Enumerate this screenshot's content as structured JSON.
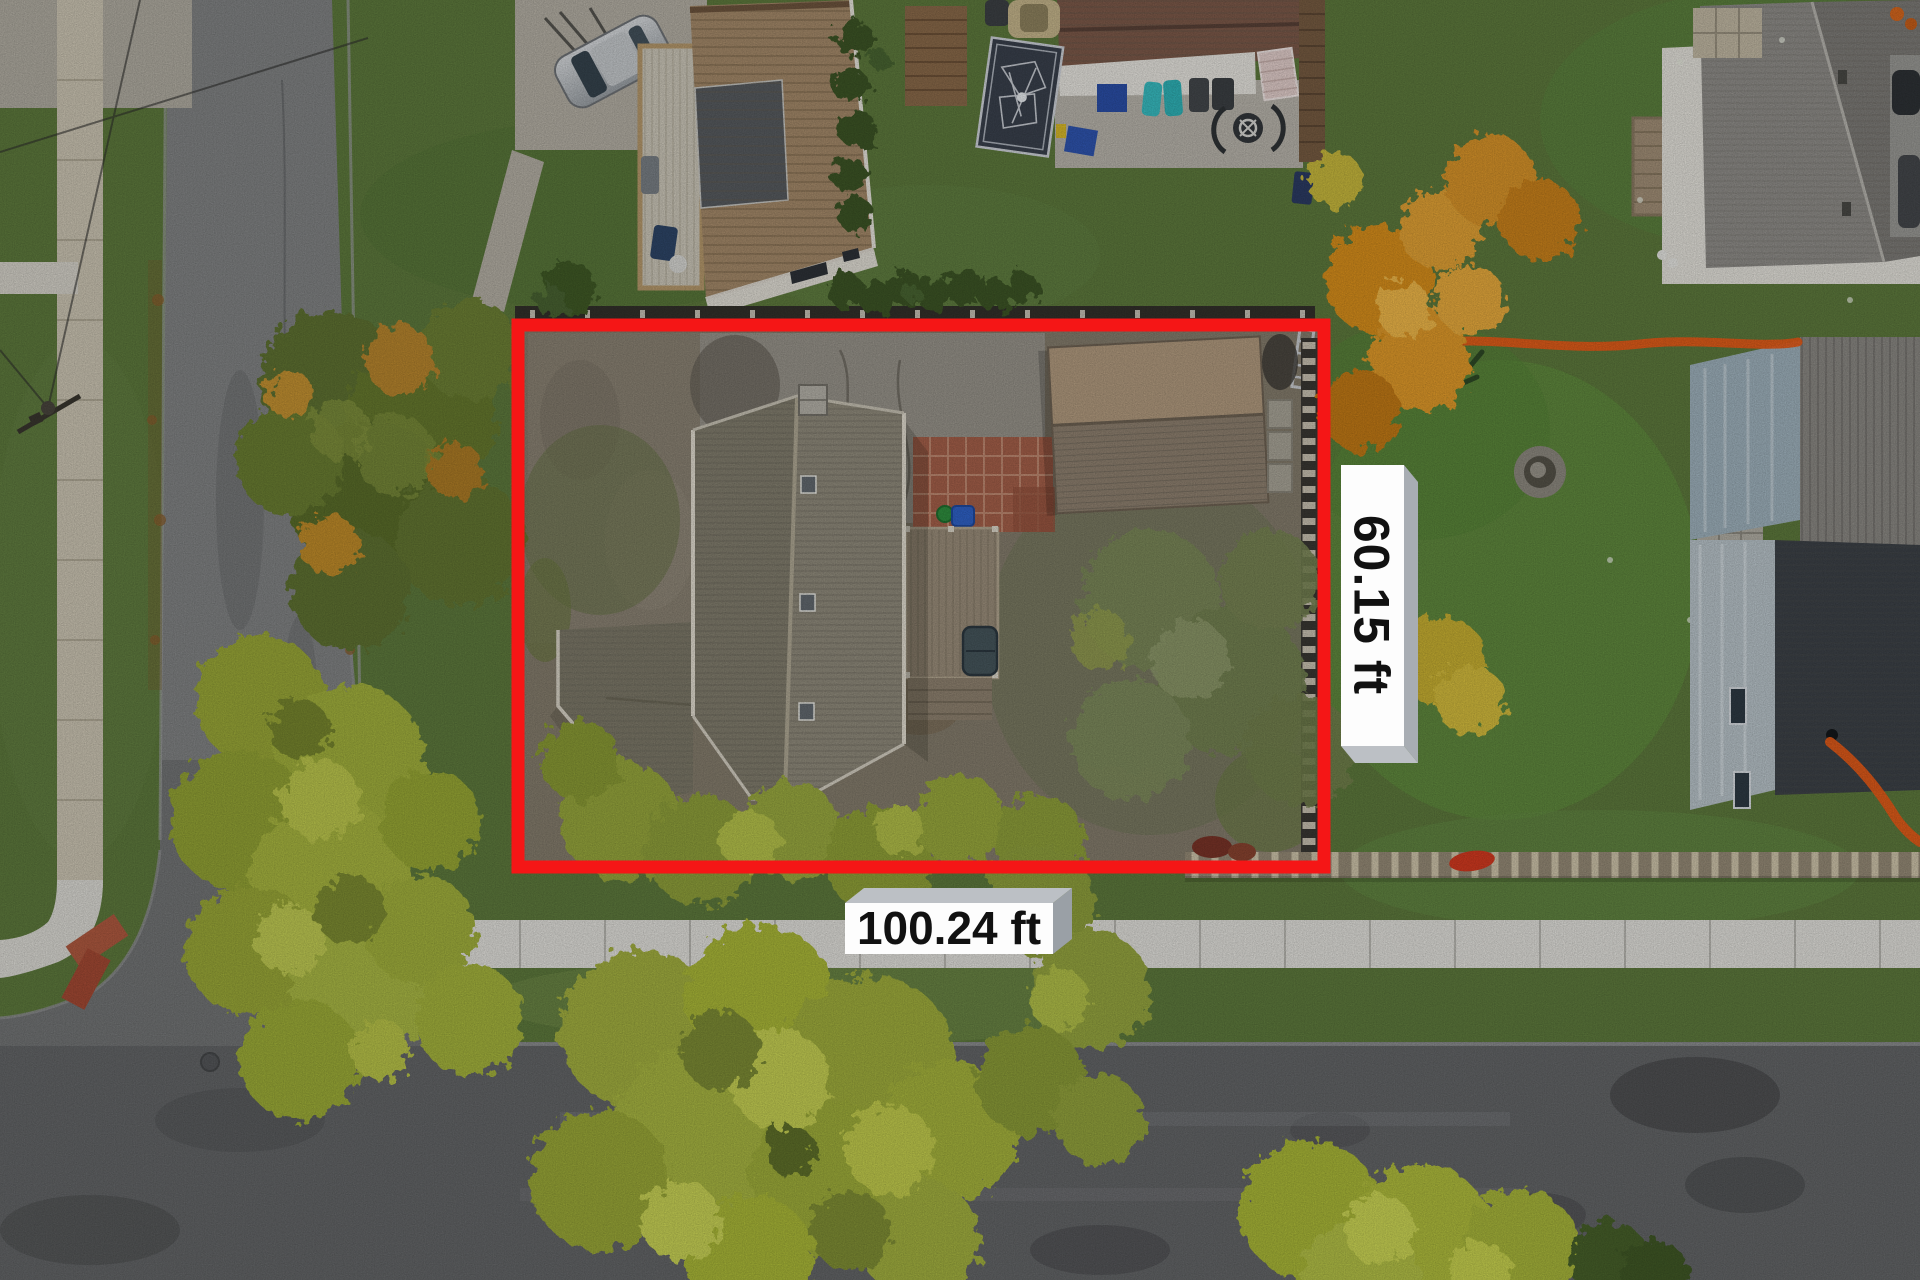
{
  "page": {
    "type": "aerial-property-lot-photo"
  },
  "overlay": {
    "boundary_color": "#f51616",
    "labels": {
      "lot_depth": {
        "text": "60.15 ft",
        "orientation": "vertical",
        "side": "right-of-lot"
      },
      "lot_frontage": {
        "text": "100.24 ft",
        "orientation": "horizontal",
        "side": "bottom-of-lot"
      }
    },
    "label_style": {
      "face_color": "#fdfdfd",
      "text_color": "#111111",
      "side_color": "#a8adb3",
      "top_color": "#bcc0c5"
    }
  }
}
